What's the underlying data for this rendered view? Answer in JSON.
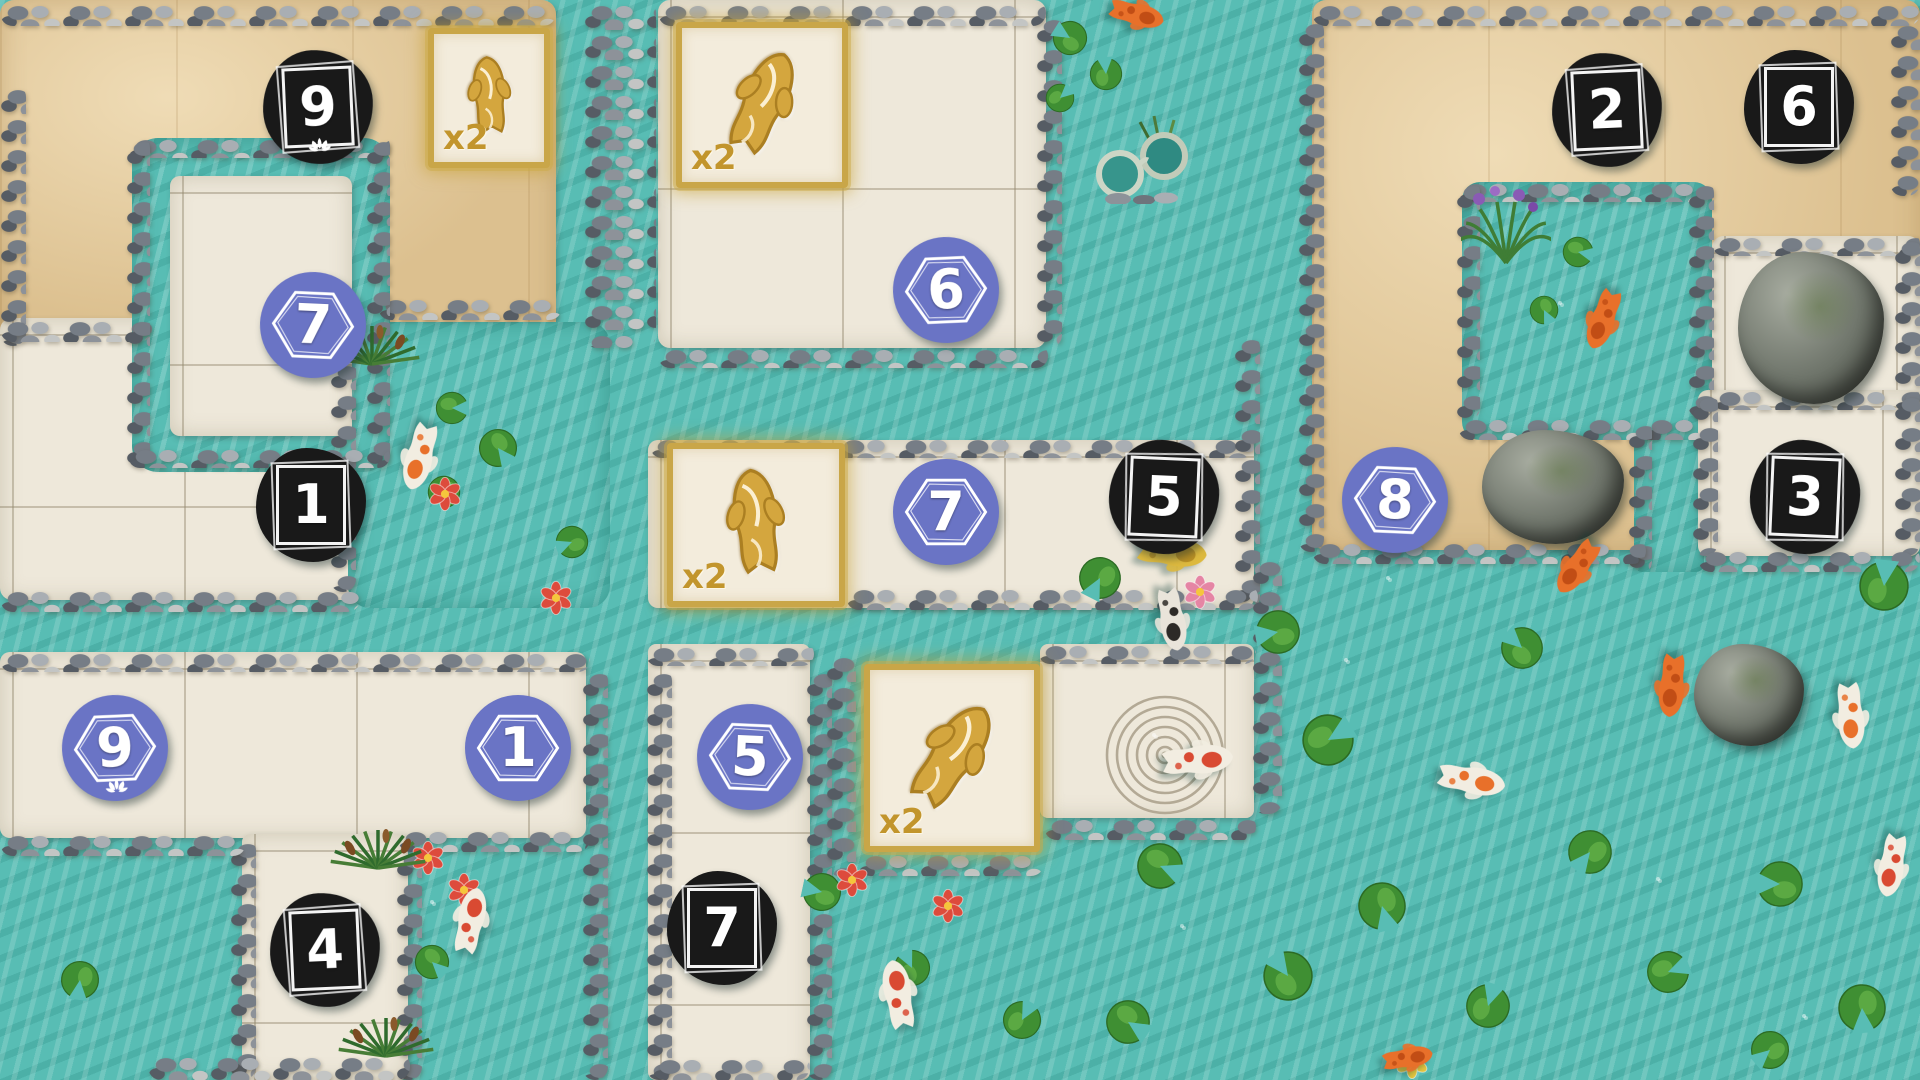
{
  "board": {
    "width": 1920,
    "height": 1080,
    "palette": {
      "water": "#58bdb4",
      "sand": "#dcc08f",
      "path": "#eee8da",
      "pebble_gray": "#8d9299",
      "token_black": "#191919",
      "token_purple": "#6a74c5",
      "gold_border": "#c9a648",
      "gold_text": "#c2952c",
      "koi_orange": "#e8702a",
      "lily_green": "#3f8f33"
    }
  },
  "zones": [
    {
      "name": "sand-northwest",
      "type": "sand",
      "x": 0,
      "y": 0,
      "w": 556,
      "h": 345,
      "r": 14
    },
    {
      "name": "path-northwest-lower",
      "type": "path",
      "x": 0,
      "y": 318,
      "w": 392,
      "h": 282,
      "r": 12
    },
    {
      "name": "pool-northwest",
      "type": "water",
      "x": 348,
      "y": 322,
      "w": 262,
      "h": 286,
      "r": 22
    },
    {
      "name": "moat-ring",
      "type": "water",
      "x": 132,
      "y": 138,
      "w": 258,
      "h": 334,
      "r": 26
    },
    {
      "name": "path-ring-inner",
      "type": "path",
      "x": 170,
      "y": 176,
      "w": 182,
      "h": 260,
      "r": 10
    },
    {
      "name": "path-north-middle",
      "type": "path",
      "x": 658,
      "y": 0,
      "w": 388,
      "h": 348,
      "r": 12
    },
    {
      "name": "path-middle",
      "type": "path",
      "x": 648,
      "y": 440,
      "w": 606,
      "h": 168,
      "r": 10
    },
    {
      "name": "sand-northeast",
      "type": "sand",
      "x": 1312,
      "y": 0,
      "w": 608,
      "h": 550,
      "r": 14
    },
    {
      "name": "stream-east",
      "type": "water",
      "x": 1634,
      "y": 426,
      "w": 70,
      "h": 146,
      "r": 8
    },
    {
      "name": "pond-northeast",
      "type": "water",
      "x": 1462,
      "y": 182,
      "w": 250,
      "h": 258,
      "r": 18
    },
    {
      "name": "path-rock-pen",
      "type": "path",
      "x": 1712,
      "y": 236,
      "w": 208,
      "h": 174,
      "r": 12
    },
    {
      "name": "path-east",
      "type": "path",
      "x": 1698,
      "y": 390,
      "w": 222,
      "h": 166,
      "r": 10
    },
    {
      "name": "path-southwest",
      "type": "path",
      "x": 0,
      "y": 652,
      "w": 586,
      "h": 186,
      "r": 10
    },
    {
      "name": "path-southwest-strip",
      "type": "path",
      "x": 242,
      "y": 834,
      "w": 166,
      "h": 246,
      "r": 8
    },
    {
      "name": "path-south-center",
      "type": "path",
      "x": 648,
      "y": 644,
      "w": 162,
      "h": 436,
      "r": 8
    },
    {
      "name": "path-spiral",
      "type": "path",
      "x": 1040,
      "y": 644,
      "w": 214,
      "h": 174,
      "r": 8
    }
  ],
  "pebble_strips": [
    {
      "x": 0,
      "y": 0,
      "w": 556,
      "h": 26
    },
    {
      "x": 658,
      "y": 0,
      "w": 388,
      "h": 26
    },
    {
      "x": 1312,
      "y": 0,
      "w": 608,
      "h": 26
    },
    {
      "x": 0,
      "y": 84,
      "w": 26,
      "h": 262
    },
    {
      "x": 584,
      "y": 0,
      "w": 72,
      "h": 348
    },
    {
      "x": 0,
      "y": 316,
      "w": 152,
      "h": 26
    },
    {
      "x": 378,
      "y": 294,
      "w": 184,
      "h": 26
    },
    {
      "x": 330,
      "y": 330,
      "w": 26,
      "h": 262
    },
    {
      "x": 128,
      "y": 134,
      "w": 262,
      "h": 24
    },
    {
      "x": 126,
      "y": 136,
      "w": 24,
      "h": 332
    },
    {
      "x": 366,
      "y": 136,
      "w": 24,
      "h": 332
    },
    {
      "x": 128,
      "y": 444,
      "w": 262,
      "h": 24
    },
    {
      "x": 658,
      "y": 344,
      "w": 390,
      "h": 24
    },
    {
      "x": 650,
      "y": 434,
      "w": 604,
      "h": 24
    },
    {
      "x": 1036,
      "y": 14,
      "w": 26,
      "h": 334
    },
    {
      "x": 1298,
      "y": 18,
      "w": 26,
      "h": 534
    },
    {
      "x": 1234,
      "y": 334,
      "w": 26,
      "h": 276
    },
    {
      "x": 1458,
      "y": 178,
      "w": 254,
      "h": 24
    },
    {
      "x": 1456,
      "y": 180,
      "w": 24,
      "h": 240
    },
    {
      "x": 1458,
      "y": 414,
      "w": 254,
      "h": 26
    },
    {
      "x": 1688,
      "y": 180,
      "w": 26,
      "h": 238
    },
    {
      "x": 1712,
      "y": 232,
      "w": 208,
      "h": 24
    },
    {
      "x": 1894,
      "y": 236,
      "w": 26,
      "h": 176
    },
    {
      "x": 1712,
      "y": 386,
      "w": 208,
      "h": 24
    },
    {
      "x": 1890,
      "y": 20,
      "w": 30,
      "h": 176
    },
    {
      "x": 1628,
      "y": 420,
      "w": 24,
      "h": 154
    },
    {
      "x": 1692,
      "y": 392,
      "w": 26,
      "h": 164
    },
    {
      "x": 1894,
      "y": 392,
      "w": 26,
      "h": 164
    },
    {
      "x": 1312,
      "y": 538,
      "w": 334,
      "h": 26
    },
    {
      "x": 1698,
      "y": 546,
      "w": 222,
      "h": 26
    },
    {
      "x": 0,
      "y": 586,
      "w": 360,
      "h": 26
    },
    {
      "x": 846,
      "y": 584,
      "w": 412,
      "h": 26
    },
    {
      "x": 0,
      "y": 648,
      "w": 590,
      "h": 24
    },
    {
      "x": 646,
      "y": 642,
      "w": 168,
      "h": 24
    },
    {
      "x": 1038,
      "y": 640,
      "w": 218,
      "h": 24
    },
    {
      "x": 582,
      "y": 668,
      "w": 26,
      "h": 412
    },
    {
      "x": 646,
      "y": 668,
      "w": 26,
      "h": 412
    },
    {
      "x": 806,
      "y": 668,
      "w": 26,
      "h": 412
    },
    {
      "x": 826,
      "y": 652,
      "w": 30,
      "h": 224
    },
    {
      "x": 858,
      "y": 850,
      "w": 186,
      "h": 26
    },
    {
      "x": 1252,
      "y": 556,
      "w": 30,
      "h": 258
    },
    {
      "x": 1044,
      "y": 814,
      "w": 212,
      "h": 26
    },
    {
      "x": 398,
      "y": 826,
      "w": 192,
      "h": 26
    },
    {
      "x": 396,
      "y": 848,
      "w": 26,
      "h": 232
    },
    {
      "x": 230,
      "y": 838,
      "w": 26,
      "h": 242
    },
    {
      "x": 0,
      "y": 830,
      "w": 246,
      "h": 26
    },
    {
      "x": 148,
      "y": 1052,
      "w": 262,
      "h": 28
    },
    {
      "x": 652,
      "y": 1054,
      "w": 158,
      "h": 26
    }
  ],
  "tokens": [
    {
      "shape": "black",
      "value": "9",
      "x": 318,
      "y": 107,
      "lotus": true
    },
    {
      "shape": "black",
      "value": "1",
      "x": 311,
      "y": 505,
      "lotus": false
    },
    {
      "shape": "black",
      "value": "5",
      "x": 1164,
      "y": 497,
      "lotus": false
    },
    {
      "shape": "black",
      "value": "2",
      "x": 1607,
      "y": 110,
      "lotus": false
    },
    {
      "shape": "black",
      "value": "6",
      "x": 1799,
      "y": 107,
      "lotus": false
    },
    {
      "shape": "black",
      "value": "3",
      "x": 1805,
      "y": 497,
      "lotus": false
    },
    {
      "shape": "black",
      "value": "4",
      "x": 325,
      "y": 950,
      "lotus": false
    },
    {
      "shape": "black",
      "value": "7",
      "x": 722,
      "y": 928,
      "lotus": false
    },
    {
      "shape": "purple",
      "value": "7",
      "x": 313,
      "y": 325,
      "lotus": false
    },
    {
      "shape": "purple",
      "value": "6",
      "x": 946,
      "y": 290,
      "lotus": false
    },
    {
      "shape": "purple",
      "value": "7",
      "x": 946,
      "y": 512,
      "lotus": false
    },
    {
      "shape": "purple",
      "value": "8",
      "x": 1395,
      "y": 500,
      "lotus": false
    },
    {
      "shape": "purple",
      "value": "9",
      "x": 115,
      "y": 748,
      "lotus": true
    },
    {
      "shape": "purple",
      "value": "1",
      "x": 518,
      "y": 748,
      "lotus": false
    },
    {
      "shape": "purple",
      "value": "5",
      "x": 750,
      "y": 757,
      "lotus": false
    }
  ],
  "multiplier_tiles": [
    {
      "label": "x2",
      "x": 428,
      "y": 28,
      "w": 122,
      "h": 140,
      "koi_rotation": -4
    },
    {
      "label": "x2",
      "x": 676,
      "y": 22,
      "w": 172,
      "h": 166,
      "koi_rotation": 24
    },
    {
      "label": "x2",
      "x": 667,
      "y": 443,
      "w": 178,
      "h": 164,
      "koi_rotation": -6
    },
    {
      "label": "x2",
      "x": 864,
      "y": 664,
      "w": 176,
      "h": 188,
      "koi_rotation": 34
    }
  ],
  "rocks": [
    {
      "x": 1738,
      "y": 252,
      "w": 146,
      "h": 152
    },
    {
      "x": 1482,
      "y": 430,
      "w": 142,
      "h": 114
    },
    {
      "x": 1694,
      "y": 644,
      "w": 110,
      "h": 102
    }
  ],
  "koi": [
    {
      "style": "white-orange",
      "x": 420,
      "y": 455,
      "rot": 195,
      "len": 86
    },
    {
      "style": "orange",
      "x": 1603,
      "y": 318,
      "rot": 200,
      "len": 78
    },
    {
      "style": "orange",
      "x": 1135,
      "y": 14,
      "rot": 105,
      "len": 70
    },
    {
      "style": "yellow",
      "x": 1170,
      "y": 552,
      "rot": 95,
      "len": 88
    },
    {
      "style": "black-white",
      "x": 1172,
      "y": 618,
      "rot": 170,
      "len": 80
    },
    {
      "style": "orange",
      "x": 1578,
      "y": 566,
      "rot": 215,
      "len": 76
    },
    {
      "style": "orange",
      "x": 1672,
      "y": 684,
      "rot": 185,
      "len": 80
    },
    {
      "style": "white-orange",
      "x": 1850,
      "y": 714,
      "rot": 175,
      "len": 84
    },
    {
      "style": "white-red",
      "x": 1196,
      "y": 760,
      "rot": 85,
      "len": 90
    },
    {
      "style": "white-orange",
      "x": 1470,
      "y": 780,
      "rot": 100,
      "len": 86
    },
    {
      "style": "white-red",
      "x": 898,
      "y": 996,
      "rot": -10,
      "len": 88
    },
    {
      "style": "white-red",
      "x": 470,
      "y": 922,
      "rot": 12,
      "len": 84
    },
    {
      "style": "orange",
      "x": 1406,
      "y": 1058,
      "rot": 80,
      "len": 64
    },
    {
      "style": "white-red",
      "x": 1892,
      "y": 864,
      "rot": 190,
      "len": 80
    }
  ],
  "lily_pads": [
    {
      "x": 452,
      "y": 408,
      "s": 34
    },
    {
      "x": 498,
      "y": 448,
      "s": 40
    },
    {
      "x": 444,
      "y": 492,
      "s": 34
    },
    {
      "x": 572,
      "y": 542,
      "s": 34
    },
    {
      "x": 1070,
      "y": 38,
      "s": 36
    },
    {
      "x": 1106,
      "y": 74,
      "s": 34
    },
    {
      "x": 1060,
      "y": 98,
      "s": 30
    },
    {
      "x": 1578,
      "y": 252,
      "s": 32
    },
    {
      "x": 1544,
      "y": 310,
      "s": 30
    },
    {
      "x": 1100,
      "y": 578,
      "s": 44
    },
    {
      "x": 1278,
      "y": 632,
      "s": 46
    },
    {
      "x": 1522,
      "y": 648,
      "s": 44
    },
    {
      "x": 1884,
      "y": 586,
      "s": 52
    },
    {
      "x": 1328,
      "y": 740,
      "s": 54
    },
    {
      "x": 1160,
      "y": 866,
      "s": 48
    },
    {
      "x": 1382,
      "y": 906,
      "s": 50
    },
    {
      "x": 1590,
      "y": 852,
      "s": 46
    },
    {
      "x": 1780,
      "y": 884,
      "s": 48
    },
    {
      "x": 1288,
      "y": 976,
      "s": 52
    },
    {
      "x": 1488,
      "y": 1006,
      "s": 46
    },
    {
      "x": 1668,
      "y": 972,
      "s": 44
    },
    {
      "x": 1128,
      "y": 1022,
      "s": 46
    },
    {
      "x": 1862,
      "y": 1008,
      "s": 50
    },
    {
      "x": 1770,
      "y": 1050,
      "s": 40
    },
    {
      "x": 822,
      "y": 892,
      "s": 40
    },
    {
      "x": 912,
      "y": 968,
      "s": 38
    },
    {
      "x": 1022,
      "y": 1020,
      "s": 40
    },
    {
      "x": 500,
      "y": 722,
      "s": 36
    },
    {
      "x": 432,
      "y": 962,
      "s": 36
    },
    {
      "x": 80,
      "y": 980,
      "s": 40
    }
  ],
  "flowers": [
    {
      "x": 445,
      "y": 494,
      "color": "red"
    },
    {
      "x": 556,
      "y": 598,
      "color": "red"
    },
    {
      "x": 1200,
      "y": 592,
      "color": "pink"
    },
    {
      "x": 852,
      "y": 880,
      "color": "red"
    },
    {
      "x": 948,
      "y": 906,
      "color": "red"
    },
    {
      "x": 428,
      "y": 858,
      "color": "red"
    },
    {
      "x": 464,
      "y": 890,
      "color": "red"
    },
    {
      "x": 1412,
      "y": 1062,
      "color": "yellow"
    }
  ],
  "plants": [
    {
      "type": "grass",
      "x": 372,
      "y": 364
    },
    {
      "type": "grass",
      "x": 378,
      "y": 868
    },
    {
      "type": "grass",
      "x": 386,
      "y": 1056
    },
    {
      "type": "iris",
      "x": 1506,
      "y": 230
    }
  ],
  "ripples": [
    {
      "x": 1438,
      "y": 612,
      "r": 52
    },
    {
      "x": 1712,
      "y": 916,
      "r": 56
    },
    {
      "x": 1228,
      "y": 958,
      "r": 48
    },
    {
      "x": 1848,
      "y": 1046,
      "r": 46
    },
    {
      "x": 1378,
      "y": 682,
      "r": 34
    },
    {
      "x": 1600,
      "y": 330,
      "r": 42
    },
    {
      "x": 470,
      "y": 928,
      "r": 40
    },
    {
      "x": 1196,
      "y": 764,
      "r": 44
    }
  ],
  "ornaments": [
    {
      "type": "spectacles",
      "x": 1088,
      "y": 112,
      "w": 116,
      "h": 92
    },
    {
      "type": "zen-spiral",
      "x": 1165,
      "y": 755,
      "r": 62
    }
  ]
}
